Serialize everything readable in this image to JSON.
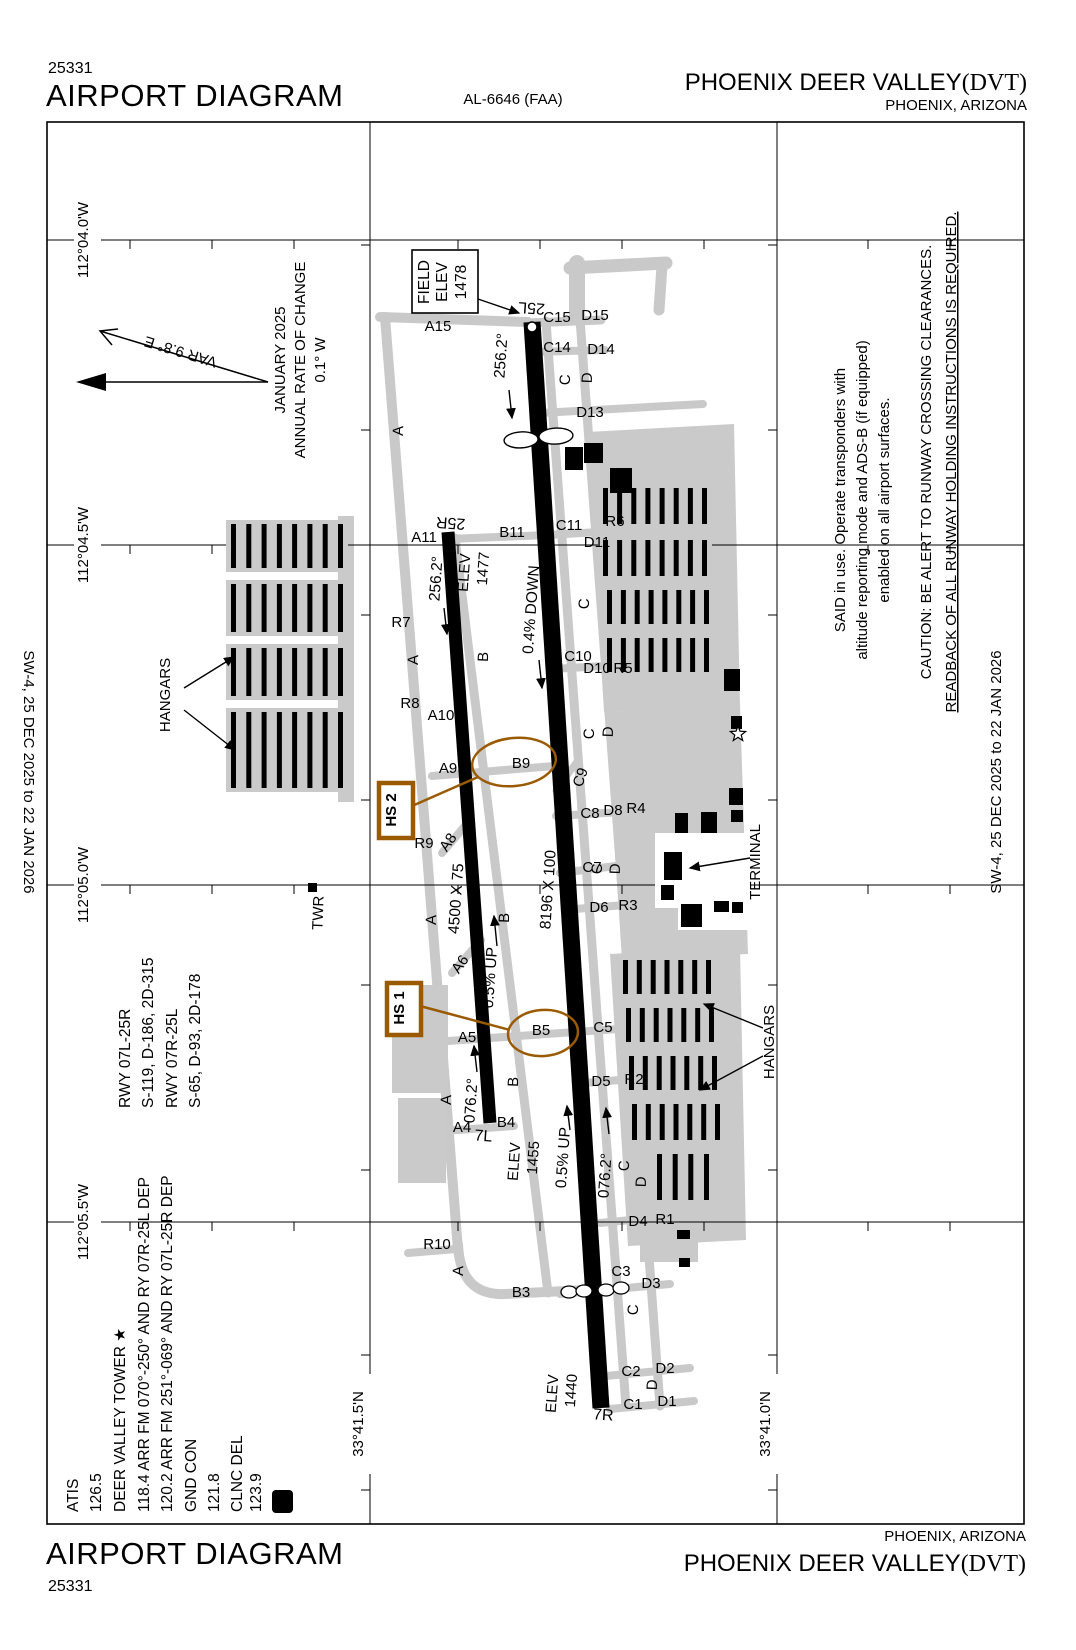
{
  "header": {
    "chart_number": "25331",
    "title": "AIRPORT DIAGRAM",
    "al_number": "AL-6646 (FAA)",
    "airport_name": "PHOENIX DEER VALLEY",
    "airport_id": "(DVT)",
    "city_state": "PHOENIX, ARIZONA"
  },
  "footer": {
    "title": "AIRPORT DIAGRAM",
    "chart_number": "25331",
    "airport_name": "PHOENIX DEER VALLEY",
    "airport_id": "(DVT)",
    "city_state": "PHOENIX, ARIZONA"
  },
  "colors": {
    "taxiway-gray": "#c9c9c9",
    "apron-gray": "#cacaca",
    "hotspot-brown": "#9a5b00"
  },
  "map": {
    "labels": [
      {
        "n": "lon-label-1",
        "t": "112°04.0'W",
        "x": 88,
        "y": 240,
        "r": -90
      },
      {
        "n": "lon-label-2",
        "t": "112°04.5'W",
        "x": 88,
        "y": 545,
        "r": -90
      },
      {
        "n": "lon-label-3",
        "t": "112°05.0'W",
        "x": 88,
        "y": 885,
        "r": -90
      },
      {
        "n": "lon-label-4",
        "t": "112°05.5'W",
        "x": 88,
        "y": 1222,
        "r": -90
      },
      {
        "n": "lat-label-1",
        "t": "33°41.5'N",
        "x": 363,
        "y": 1424,
        "r": -90
      },
      {
        "n": "lat-label-2",
        "t": "33°41.0'N",
        "x": 770,
        "y": 1424,
        "r": -90
      },
      {
        "n": "margin-date-left",
        "t": "SW-4,  25 DEC 2025  to  22 JAN 2026",
        "x": 24,
        "y": 772,
        "r": 90
      },
      {
        "n": "margin-date-right",
        "t": "SW-4,  25 DEC 2025  to  22 JAN 2026",
        "x": 1001,
        "y": 772,
        "r": -90
      },
      {
        "n": "comm-atis-label",
        "t": "ATIS",
        "x": 78,
        "y": 1512,
        "r": -90,
        "a": "start",
        "s": 15.5
      },
      {
        "n": "comm-atis-freq",
        "t": "126.5",
        "x": 101,
        "y": 1512,
        "r": -90,
        "a": "start",
        "s": 15.5
      },
      {
        "n": "comm-tower-label",
        "t": "DEER VALLEY TOWER ★",
        "x": 125,
        "y": 1512,
        "r": -90,
        "a": "start",
        "s": 15.5
      },
      {
        "n": "comm-tower-freq1",
        "t": "118.4  ARR FM 070°-250° AND RY 07R-25L DEP",
        "x": 149,
        "y": 1512,
        "r": -90,
        "a": "start",
        "s": 15.5
      },
      {
        "n": "comm-tower-freq2",
        "t": "120.2  ARR FM 251°-069° AND RY 07L-25R DEP",
        "x": 172,
        "y": 1512,
        "r": -90,
        "a": "start",
        "s": 15.5
      },
      {
        "n": "comm-gnd-label",
        "t": "GND CON",
        "x": 196,
        "y": 1512,
        "r": -90,
        "a": "start",
        "s": 15.5
      },
      {
        "n": "comm-gnd-freq",
        "t": "121.8",
        "x": 219,
        "y": 1512,
        "r": -90,
        "a": "start",
        "s": 15.5
      },
      {
        "n": "comm-clnc-label",
        "t": "CLNC DEL",
        "x": 242,
        "y": 1512,
        "r": -90,
        "a": "start",
        "s": 15.5
      },
      {
        "n": "comm-clnc-freq",
        "t": "123.9",
        "x": 261,
        "y": 1512,
        "r": -90,
        "a": "start",
        "s": 15.5
      },
      {
        "n": "comm-d-symbol",
        "t": "D",
        "x": 287,
        "y": 1501,
        "r": -90,
        "s": 16,
        "w": "bold",
        "c": "#ffffff"
      },
      {
        "n": "rwy-data-1",
        "t": "RWY 07L-25R",
        "x": 130,
        "y": 1108,
        "r": -90,
        "a": "start",
        "s": 15.5
      },
      {
        "n": "rwy-data-2",
        "t": "S-119, D-186, 2D-315",
        "x": 153,
        "y": 1108,
        "r": -90,
        "a": "start",
        "s": 15.5
      },
      {
        "n": "rwy-data-3",
        "t": "RWY 07R-25L",
        "x": 177,
        "y": 1108,
        "r": -90,
        "a": "start",
        "s": 15.5
      },
      {
        "n": "rwy-data-4",
        "t": "S-65, D-93, 2D-178",
        "x": 200,
        "y": 1108,
        "r": -90,
        "a": "start",
        "s": 15.5
      },
      {
        "n": "annual-rate-1",
        "t": "JANUARY 2025",
        "x": 285,
        "y": 360,
        "r": -90
      },
      {
        "n": "annual-rate-2",
        "t": "ANNUAL RATE OF CHANGE",
        "x": 305,
        "y": 360,
        "r": -90
      },
      {
        "n": "annual-rate-3",
        "t": "0.1° W",
        "x": 325,
        "y": 360,
        "r": -90
      },
      {
        "n": "var-label",
        "t": "VAR 9.8° E",
        "x": 182,
        "y": 347,
        "r": 197
      },
      {
        "n": "note-transponder-1",
        "t": "SAID in use. Operate transponders with",
        "x": 845,
        "y": 500,
        "r": -90
      },
      {
        "n": "note-transponder-2",
        "t": "altitude reporting mode and ADS-B (if equipped)",
        "x": 867,
        "y": 500,
        "r": -90
      },
      {
        "n": "note-transponder-3",
        "t": "enabled on all airport surfaces.",
        "x": 889,
        "y": 500,
        "r": -90
      },
      {
        "n": "note-caution-1",
        "t": "CAUTION: BE ALERT TO RUNWAY CROSSING CLEARANCES.",
        "x": 931,
        "y": 462,
        "r": -90
      },
      {
        "n": "note-caution-2",
        "t": "READBACK OF ALL RUNWAY HOLDING INSTRUCTIONS IS REQUIRED.",
        "x": 956,
        "y": 462,
        "r": -90,
        "u": true
      },
      {
        "n": "field-elev-line1",
        "t": "FIELD",
        "x": 429,
        "y": 282,
        "r": -90,
        "s": 15.5
      },
      {
        "n": "field-elev-line2",
        "t": "ELEV",
        "x": 447,
        "y": 282,
        "r": -90,
        "s": 15.5
      },
      {
        "n": "field-elev-value",
        "t": "1478",
        "x": 466,
        "y": 282,
        "r": -90,
        "s": 15.5
      },
      {
        "n": "rwy-end-25l",
        "t": "25L",
        "x": 532,
        "y": 303,
        "r": 184,
        "s": 16
      },
      {
        "n": "rwy-end-25r",
        "t": "25R",
        "x": 451,
        "y": 518,
        "r": 184,
        "s": 16
      },
      {
        "n": "rwy-end-7l",
        "t": "7L",
        "x": 483,
        "y": 1141,
        "r": 4,
        "s": 16
      },
      {
        "n": "rwy-end-7r",
        "t": "7R",
        "x": 603,
        "y": 1420,
        "r": 4,
        "s": 16
      },
      {
        "n": "rwy-dim-short",
        "t": "4500 X 75",
        "x": 461,
        "y": 899,
        "r": -86,
        "s": 15.5
      },
      {
        "n": "rwy-dim-main",
        "t": "8196 X 100",
        "x": 553,
        "y": 890,
        "r": -86,
        "s": 15.5
      },
      {
        "n": "elev-1477-label",
        "t": "ELEV",
        "x": 469,
        "y": 573,
        "r": -86
      },
      {
        "n": "elev-1477-value",
        "t": "1477",
        "x": 488,
        "y": 569,
        "r": -86
      },
      {
        "n": "elev-1455-label",
        "t": "ELEV",
        "x": 519,
        "y": 1162,
        "r": -86
      },
      {
        "n": "elev-1455-value",
        "t": "1455",
        "x": 538,
        "y": 1158,
        "r": -86
      },
      {
        "n": "elev-1440-label",
        "t": "ELEV",
        "x": 557,
        "y": 1394,
        "r": -86
      },
      {
        "n": "elev-1440-value",
        "t": "1440",
        "x": 576,
        "y": 1391,
        "r": -86
      },
      {
        "n": "hdg-256-1",
        "t": "256.2°",
        "x": 506,
        "y": 356,
        "r": -86,
        "s": 15.5
      },
      {
        "n": "hdg-256-2",
        "t": "256.2°",
        "x": 441,
        "y": 579,
        "r": -86,
        "s": 15.5
      },
      {
        "n": "slope-04-down",
        "t": "0.4% DOWN",
        "x": 536,
        "y": 610,
        "r": -86,
        "s": 15.5
      },
      {
        "n": "slope-05-up-1",
        "t": "0.5% UP",
        "x": 495,
        "y": 978,
        "r": -86,
        "s": 15.5
      },
      {
        "n": "slope-05-up-2",
        "t": "0.5% UP",
        "x": 568,
        "y": 1158,
        "r": -86,
        "s": 15.5
      },
      {
        "n": "hdg-076-1",
        "t": "076.2°",
        "x": 476,
        "y": 1101,
        "r": -86,
        "s": 15.5
      },
      {
        "n": "hdg-076-2",
        "t": "076.2°",
        "x": 610,
        "y": 1176,
        "r": -86,
        "s": 15.5
      },
      {
        "n": "taxiway-label-a15",
        "t": "A15",
        "x": 438,
        "y": 331
      },
      {
        "n": "taxiway-label-a11",
        "t": "A11",
        "x": 424,
        "y": 542
      },
      {
        "n": "taxiway-label-b11",
        "t": "B11",
        "x": 512,
        "y": 537
      },
      {
        "n": "taxiway-label-c11",
        "t": "C11",
        "x": 569,
        "y": 530
      },
      {
        "n": "taxiway-label-d11",
        "t": "D11",
        "x": 597,
        "y": 547
      },
      {
        "n": "taxiway-label-r6",
        "t": "R6",
        "x": 615,
        "y": 526
      },
      {
        "n": "taxiway-label-r7",
        "t": "R7",
        "x": 401,
        "y": 627
      },
      {
        "n": "taxiway-label-c10",
        "t": "C10",
        "x": 578,
        "y": 661
      },
      {
        "n": "taxiway-label-d10",
        "t": "D10",
        "x": 597,
        "y": 673
      },
      {
        "n": "taxiway-label-r5",
        "t": "R5",
        "x": 623,
        "y": 673
      },
      {
        "n": "taxiway-label-r8",
        "t": "R8",
        "x": 410,
        "y": 708
      },
      {
        "n": "taxiway-label-a10",
        "t": "A10",
        "x": 441,
        "y": 720
      },
      {
        "n": "taxiway-label-a9",
        "t": "A9",
        "x": 448,
        "y": 773
      },
      {
        "n": "taxiway-label-b9",
        "t": "B9",
        "x": 521,
        "y": 768
      },
      {
        "n": "taxiway-label-c9",
        "t": "C9",
        "x": 585,
        "y": 779,
        "r": -70
      },
      {
        "n": "taxiway-label-c8",
        "t": "C8",
        "x": 590,
        "y": 818
      },
      {
        "n": "taxiway-label-d8",
        "t": "D8",
        "x": 613,
        "y": 815
      },
      {
        "n": "taxiway-label-r4",
        "t": "R4",
        "x": 636,
        "y": 813
      },
      {
        "n": "taxiway-label-r9",
        "t": "R9",
        "x": 424,
        "y": 848
      },
      {
        "n": "taxiway-label-a8",
        "t": "A8",
        "x": 452,
        "y": 845,
        "r": -55
      },
      {
        "n": "taxiway-label-c7",
        "t": "C7",
        "x": 592,
        "y": 872
      },
      {
        "n": "taxiway-label-a6",
        "t": "A6",
        "x": 464,
        "y": 967,
        "r": -55
      },
      {
        "n": "taxiway-label-a5",
        "t": "A5",
        "x": 467,
        "y": 1042
      },
      {
        "n": "taxiway-label-b5",
        "t": "B5",
        "x": 541,
        "y": 1035
      },
      {
        "n": "taxiway-label-c5",
        "t": "C5",
        "x": 603,
        "y": 1032
      },
      {
        "n": "taxiway-label-d6",
        "t": "D6",
        "x": 599,
        "y": 912
      },
      {
        "n": "taxiway-label-r3",
        "t": "R3",
        "x": 628,
        "y": 910
      },
      {
        "n": "taxiway-label-d5",
        "t": "D5",
        "x": 601,
        "y": 1086
      },
      {
        "n": "taxiway-label-r2",
        "t": "R2",
        "x": 634,
        "y": 1084
      },
      {
        "n": "taxiway-label-a4",
        "t": "A4",
        "x": 462,
        "y": 1132
      },
      {
        "n": "taxiway-label-b4",
        "t": "B4",
        "x": 506,
        "y": 1127
      },
      {
        "n": "taxiway-label-r10",
        "t": "R10",
        "x": 437,
        "y": 1249
      },
      {
        "n": "taxiway-label-b3",
        "t": "B3",
        "x": 521,
        "y": 1297
      },
      {
        "n": "taxiway-label-c3",
        "t": "C3",
        "x": 621,
        "y": 1276
      },
      {
        "n": "taxiway-label-d3",
        "t": "D3",
        "x": 651,
        "y": 1288
      },
      {
        "n": "taxiway-label-d4",
        "t": "D4",
        "x": 638,
        "y": 1226
      },
      {
        "n": "taxiway-label-r1",
        "t": "R1",
        "x": 665,
        "y": 1224
      },
      {
        "n": "taxiway-label-c2",
        "t": "C2",
        "x": 631,
        "y": 1376
      },
      {
        "n": "taxiway-label-d2",
        "t": "D2",
        "x": 665,
        "y": 1373
      },
      {
        "n": "taxiway-label-c1",
        "t": "C1",
        "x": 633,
        "y": 1409
      },
      {
        "n": "taxiway-label-d1",
        "t": "D1",
        "x": 667,
        "y": 1406
      },
      {
        "n": "taxiway-label-d13",
        "t": "D13",
        "x": 590,
        "y": 417
      },
      {
        "n": "taxiway-label-c15",
        "t": "C15",
        "x": 557,
        "y": 322
      },
      {
        "n": "taxiway-label-d15",
        "t": "D15",
        "x": 595,
        "y": 320
      },
      {
        "n": "taxiway-label-c14",
        "t": "C14",
        "x": 557,
        "y": 352
      },
      {
        "n": "taxiway-label-d14",
        "t": "D14",
        "x": 601,
        "y": 354
      },
      {
        "n": "taxiway-label-a-1",
        "t": "A",
        "x": 403,
        "y": 431,
        "r": -88
      },
      {
        "n": "taxiway-label-a-2",
        "t": "A",
        "x": 418,
        "y": 660,
        "r": -88
      },
      {
        "n": "taxiway-label-a-3",
        "t": "A",
        "x": 436,
        "y": 920,
        "r": -88
      },
      {
        "n": "taxiway-label-a-4",
        "t": "A",
        "x": 451,
        "y": 1100,
        "r": -88
      },
      {
        "n": "taxiway-label-a-5",
        "t": "A",
        "x": 463,
        "y": 1271,
        "r": -88
      },
      {
        "n": "taxiway-label-b-1",
        "t": "B",
        "x": 488,
        "y": 657,
        "r": -88
      },
      {
        "n": "taxiway-label-b-2",
        "t": "B",
        "x": 509,
        "y": 918,
        "r": -88
      },
      {
        "n": "taxiway-label-b-3",
        "t": "B",
        "x": 518,
        "y": 1082,
        "r": -88
      },
      {
        "n": "taxiway-label-c-1",
        "t": "C",
        "x": 570,
        "y": 380,
        "r": -88
      },
      {
        "n": "taxiway-label-c-2",
        "t": "C",
        "x": 589,
        "y": 604,
        "r": -88
      },
      {
        "n": "taxiway-label-c-3",
        "t": "C",
        "x": 594,
        "y": 734,
        "r": -88
      },
      {
        "n": "taxiway-label-c-4",
        "t": "C",
        "x": 602,
        "y": 869,
        "r": -88
      },
      {
        "n": "taxiway-label-c-5",
        "t": "C",
        "x": 629,
        "y": 1166,
        "r": -88
      },
      {
        "n": "taxiway-label-c-6",
        "t": "C",
        "x": 638,
        "y": 1310,
        "r": -88
      },
      {
        "n": "taxiway-label-d-1",
        "t": "D",
        "x": 592,
        "y": 378,
        "r": -88
      },
      {
        "n": "taxiway-label-d-2",
        "t": "D",
        "x": 613,
        "y": 732,
        "r": -88
      },
      {
        "n": "taxiway-label-d-3",
        "t": "D",
        "x": 620,
        "y": 869,
        "r": -88
      },
      {
        "n": "taxiway-label-d-4",
        "t": "D",
        "x": 646,
        "y": 1182,
        "r": -88
      },
      {
        "n": "taxiway-label-d-5",
        "t": "D",
        "x": 657,
        "y": 1385,
        "r": -88
      },
      {
        "n": "tower-label",
        "t": "TWR",
        "x": 323,
        "y": 913,
        "r": -88
      },
      {
        "n": "hangars-label-left",
        "t": "HANGARS",
        "x": 170,
        "y": 695,
        "r": -90
      },
      {
        "n": "hangars-label-right",
        "t": "HANGARS",
        "x": 774,
        "y": 1042,
        "r": -90
      },
      {
        "n": "terminal-label",
        "t": "TERMINAL",
        "x": 760,
        "y": 862,
        "r": -90
      },
      {
        "n": "hotspot-2-label",
        "t": "HS 2",
        "x": 396,
        "y": 810,
        "r": -90,
        "w": "bold",
        "c": "#9a5b00"
      },
      {
        "n": "hotspot-1-label",
        "t": "HS 1",
        "x": 404,
        "y": 1008,
        "r": -90,
        "w": "bold",
        "c": "#9a5b00"
      }
    ]
  }
}
